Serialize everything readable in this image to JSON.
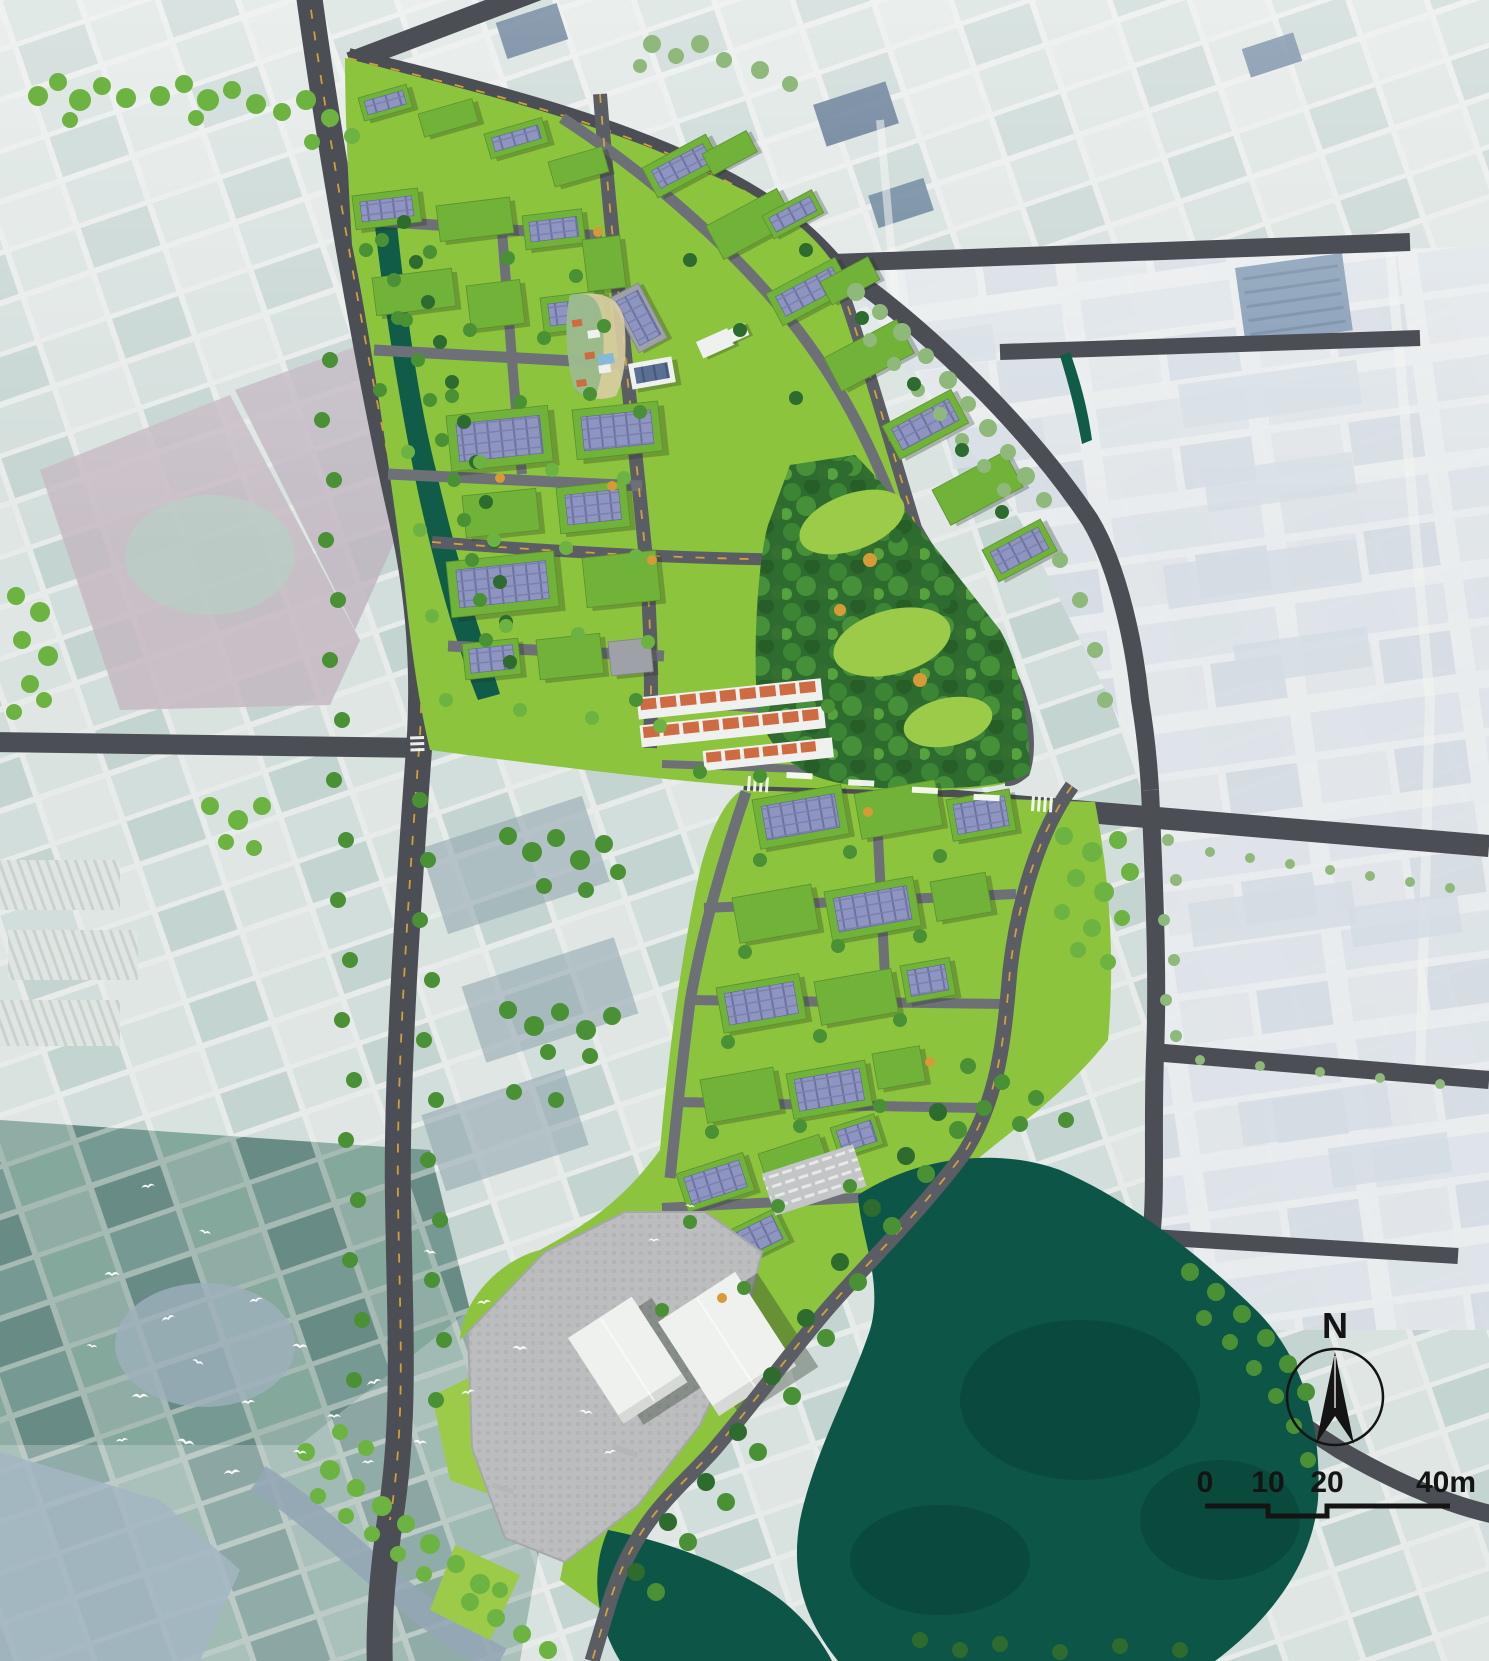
{
  "map": {
    "type": "aerial-masterplan-render",
    "compass": {
      "label": "N"
    },
    "scale_bar": {
      "tick_labels": [
        "0",
        "10",
        "20"
      ],
      "end_label": "40m"
    }
  },
  "palette": {
    "bg": "#e6eae8",
    "road_dark": "#4b4e54",
    "road_site": "#5a5d63",
    "road_minor": "#6d7077",
    "road_yellow": "#dfa937",
    "lawn": "#8cc43e",
    "lawn_light": "#9ccb4a",
    "roof_green": "#71b238",
    "gray_roof": "#9ea1a8",
    "white_bldg": "#eff1ef",
    "white_shade": "#d7d9d7",
    "tree_dark": "#2d6b2e",
    "tree_mid": "#4a9136",
    "tree_light": "#6db342",
    "tree_autumn": "#d69a36",
    "tree_muted": "#8fb97b",
    "water_canal": "#115c48",
    "water_lake": "#0d5546",
    "water_lake_dark": "#0a4739",
    "water_pale": "#9db0bc",
    "plaza": "#bcbdbe",
    "sand": "#d8cda2",
    "house_orange": "#cf6b43",
    "mauve": "#c6b8c2",
    "navy": "#415d7d",
    "industrial_roof": "#d5dde4",
    "bird": "#ffffff",
    "ink": "#141414"
  }
}
